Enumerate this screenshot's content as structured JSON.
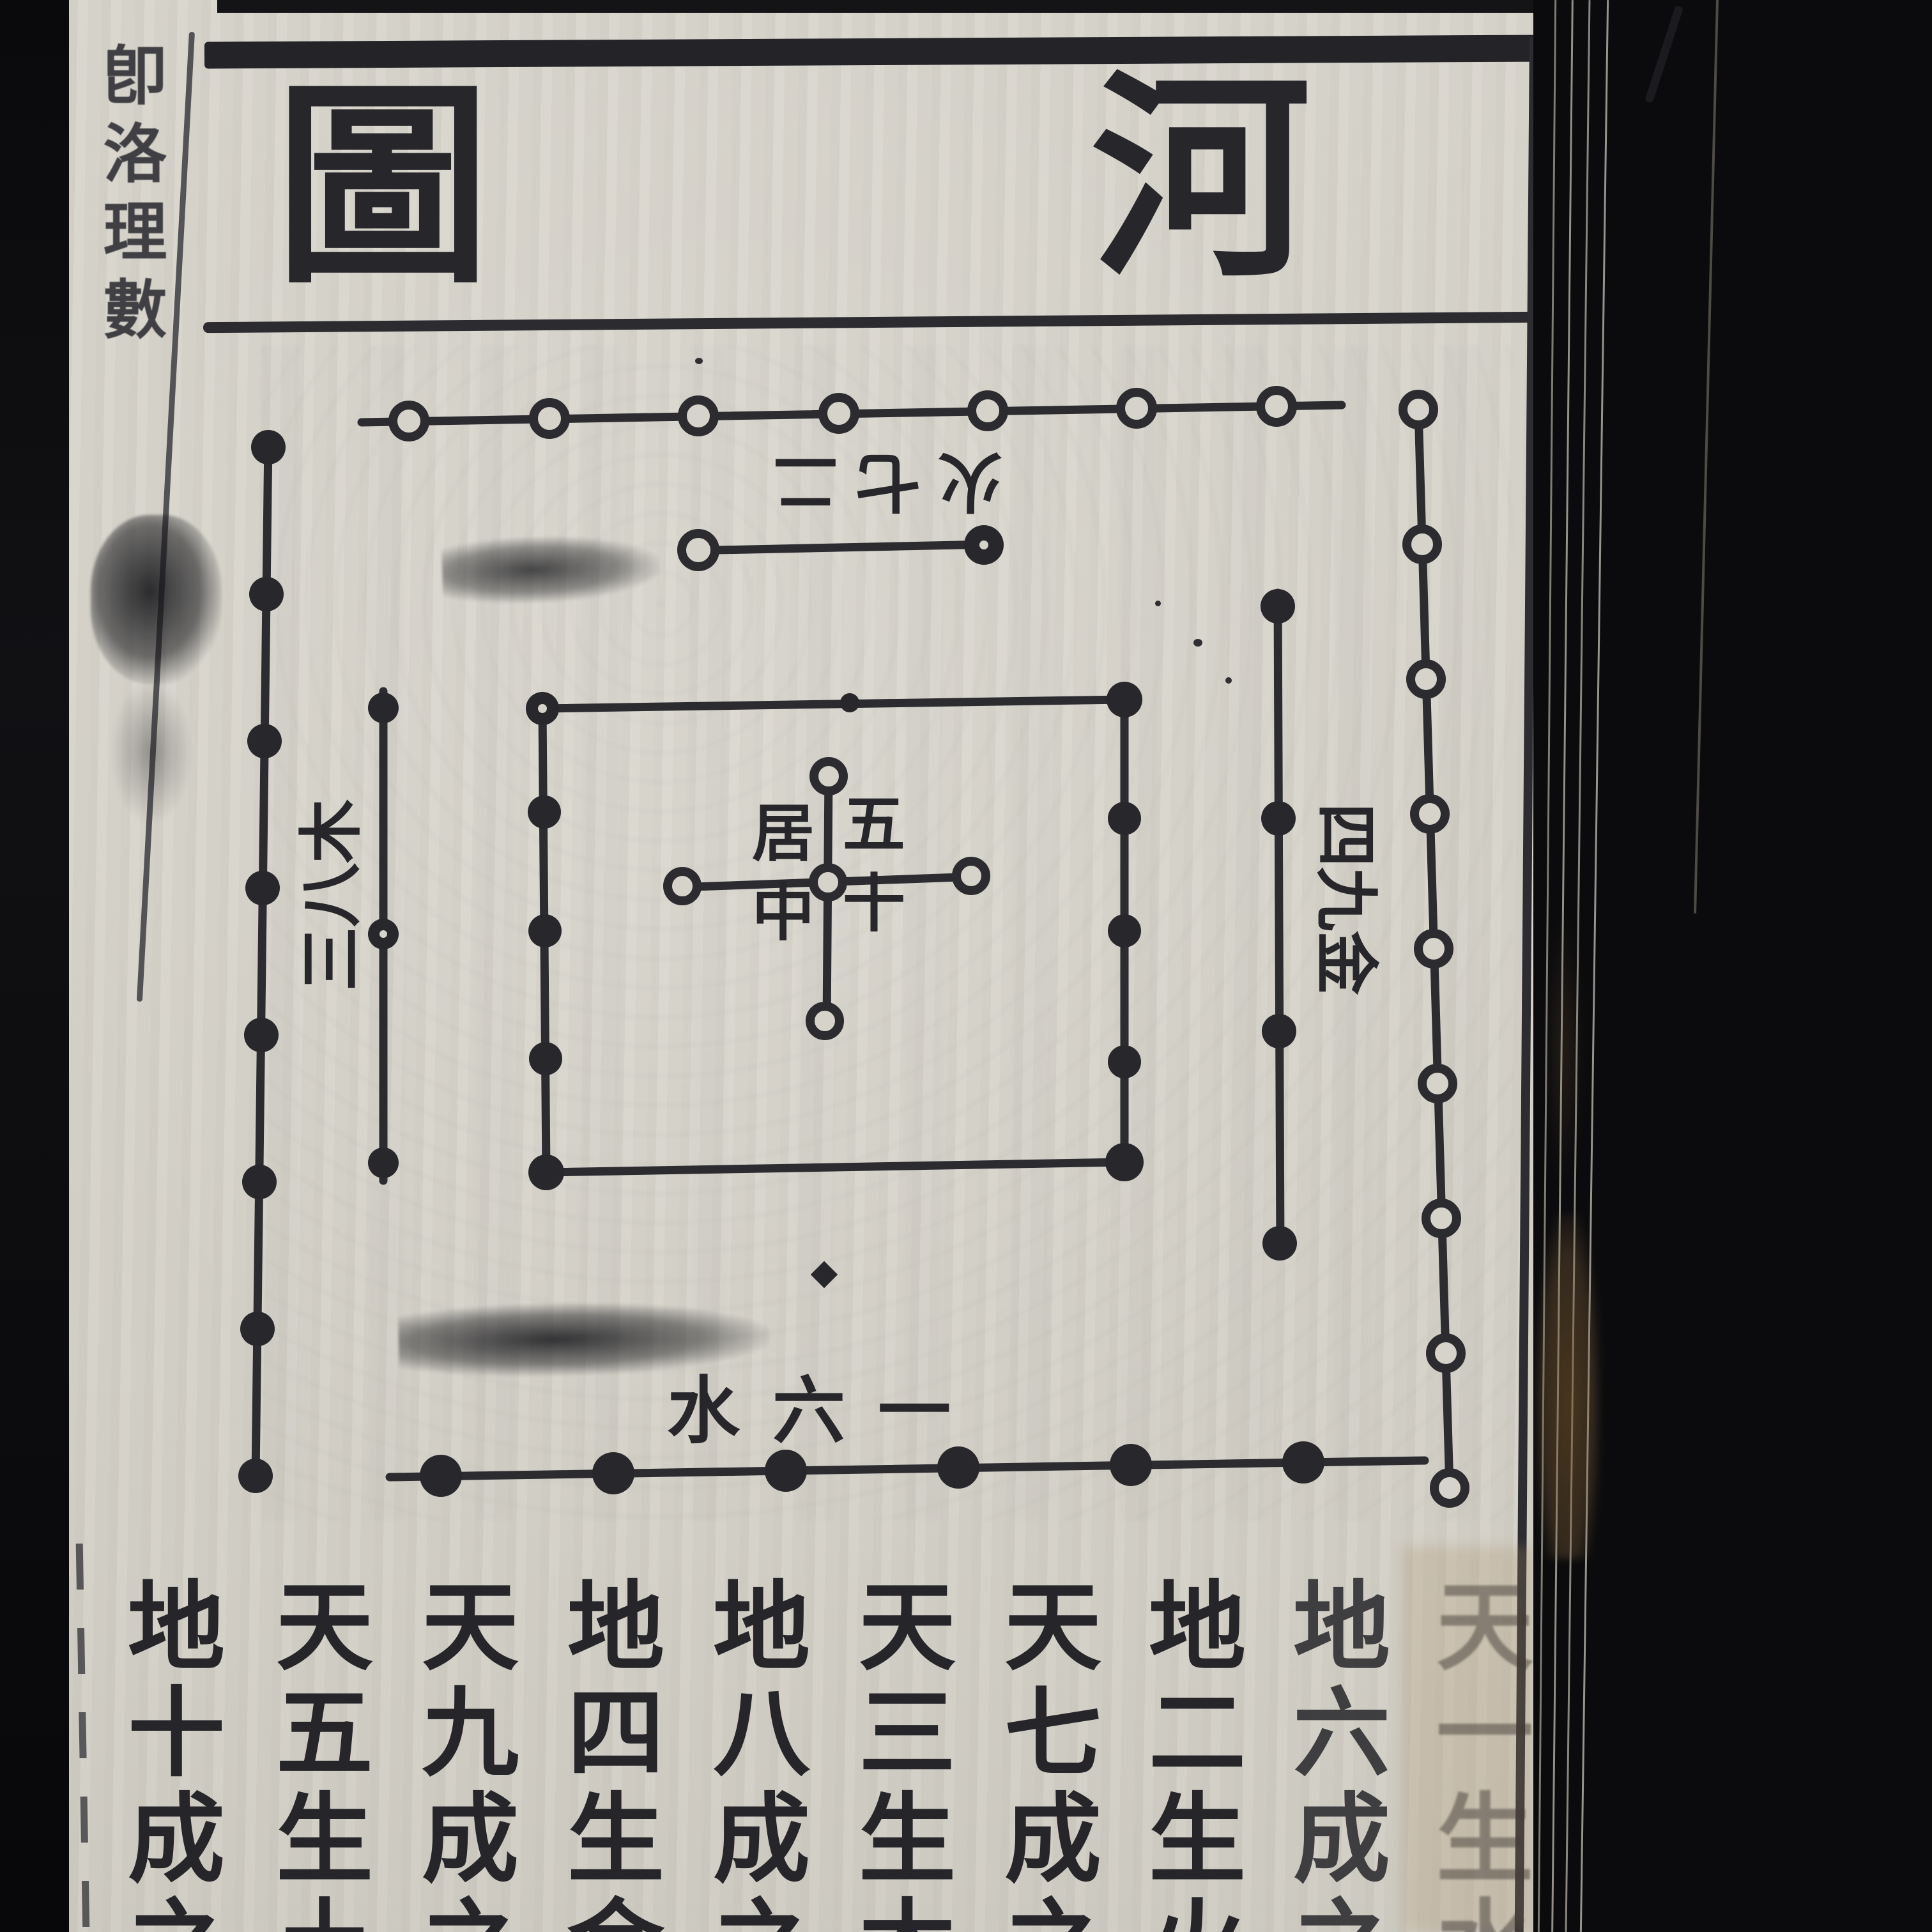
{
  "title": {
    "text": "河圖",
    "chars": [
      "河",
      "圖"
    ],
    "reading_order": "right-to-left"
  },
  "neighbor_page": {
    "partial_text": "卽洛理數"
  },
  "diagram": {
    "center": {
      "label": "五十居中",
      "cols": [
        "五十",
        "居中"
      ],
      "cross_white_dots": 5,
      "square_black_dots": 10
    },
    "top_side": {
      "label": "二七火",
      "inner_dots": 2,
      "outer_dots": 7,
      "label_orientation": "rotated-180"
    },
    "left_side": {
      "label": "三八木",
      "inner_dots": 3,
      "outer_dots": 8,
      "label_orientation": "rotated-90-ccw"
    },
    "right_side": {
      "label": "四九金",
      "inner_dots": 4,
      "outer_dots": 9,
      "label_orientation": "rotated-90-cw"
    },
    "bottom_side": {
      "label": "一六水",
      "inner_dots": 1,
      "outer_dots": 6,
      "label_orientation": "right-to-left"
    }
  },
  "bottom_text": {
    "reading_order": "columns right-to-left, top-to-bottom",
    "columns_rtl": [
      "天一生水",
      "地六成之",
      "地二生火",
      "天七成之",
      "天三生木",
      "地八成之",
      "地四生金",
      "天九成之",
      "天五生土",
      "地十成之"
    ]
  },
  "colors": {
    "paper": "#d6d3ca",
    "ink": "#2b2b2f",
    "table_cloth": "#0b0b0d",
    "fore_edge_shadow": "#443f37",
    "stain": "#8a6a45"
  }
}
